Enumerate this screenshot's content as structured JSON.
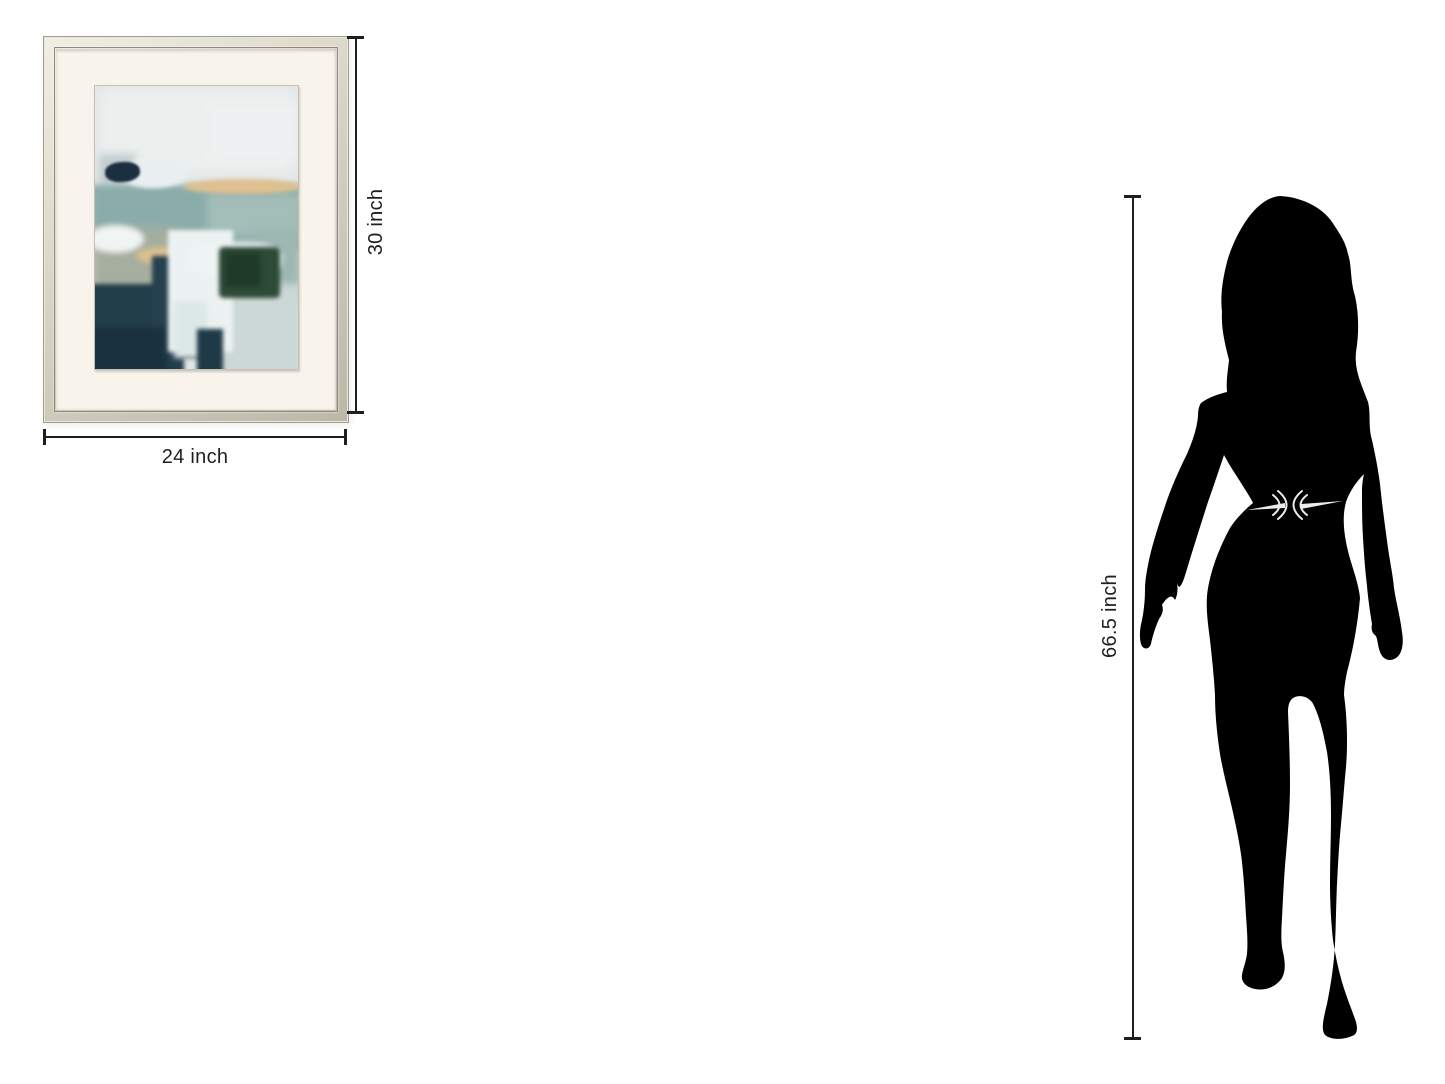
{
  "diagram": {
    "artwork": {
      "width_label": "24 inch",
      "height_label": "30 inch",
      "frame_color": "#d8d3c4",
      "mat_color": "#f8f4eb",
      "painting_layers": [
        {
          "name": "sky-haze",
          "l": 2,
          "t": 1,
          "w": 96,
          "h": 30,
          "c": "#ebefee",
          "b": 6
        },
        {
          "name": "sky-patch-right",
          "l": 55,
          "t": 6,
          "w": 44,
          "h": 20,
          "c": "#eef1f1",
          "b": 5
        },
        {
          "name": "gray-smudge-left",
          "l": 2,
          "t": 24,
          "w": 18,
          "h": 12,
          "c": "#c2cdcf",
          "b": 4
        },
        {
          "name": "sea-band",
          "l": -2,
          "t": 35,
          "w": 104,
          "h": 23,
          "c": "#8badaa",
          "b": 3
        },
        {
          "name": "sea-light-right",
          "l": 55,
          "t": 38,
          "w": 47,
          "h": 15,
          "c": "#a3bdb8",
          "b": 4
        },
        {
          "name": "white-stroke-upper",
          "l": 13,
          "t": 25,
          "w": 33,
          "h": 11,
          "c": "#e9eff0",
          "b": 2,
          "rad": "50%",
          "r": -2
        },
        {
          "name": "navy-stroke-upper",
          "l": 5,
          "t": 27,
          "w": 17,
          "h": 7,
          "c": "#1c2f3f",
          "b": 1,
          "rad": "45%",
          "r": -4
        },
        {
          "name": "tan-streak-upper",
          "l": 44,
          "t": 33,
          "w": 58,
          "h": 5,
          "c": "#dfc091",
          "b": 2,
          "rad": "50%"
        },
        {
          "name": "sage-region",
          "l": -2,
          "t": 50,
          "w": 42,
          "h": 30,
          "c": "#a6ae9f",
          "b": 5
        },
        {
          "name": "white-blob-left",
          "l": -4,
          "t": 49,
          "w": 28,
          "h": 10,
          "c": "#f0f4f3",
          "b": 3,
          "rad": "50%"
        },
        {
          "name": "tan-streak-lower",
          "l": 20,
          "t": 57,
          "w": 30,
          "h": 6,
          "c": "#ddc18e",
          "b": 3,
          "rad": "50%"
        },
        {
          "name": "teal-right-mid",
          "l": 80,
          "t": 50,
          "w": 22,
          "h": 28,
          "c": "#9db7b2",
          "b": 5
        },
        {
          "name": "light-bottom-right",
          "l": 52,
          "t": 70,
          "w": 50,
          "h": 32,
          "c": "#ccd8d6",
          "b": 4
        },
        {
          "name": "dark-teal-bottom-left",
          "l": -3,
          "t": 70,
          "w": 47,
          "h": 34,
          "c": "#223e4b",
          "b": 2
        },
        {
          "name": "navy-column-center",
          "l": 28,
          "t": 60,
          "w": 26,
          "h": 36,
          "c": "#26404f",
          "b": 2
        },
        {
          "name": "navy-deep-bottom-left",
          "l": -3,
          "t": 85,
          "w": 38,
          "h": 18,
          "c": "#1a323f",
          "b": 3
        },
        {
          "name": "white-impasto-main",
          "l": 36,
          "t": 51,
          "w": 32,
          "h": 43,
          "c": "#ecf2f2",
          "b": 2
        },
        {
          "name": "white-impasto-flare",
          "l": 46,
          "t": 55,
          "w": 46,
          "h": 12,
          "c": "#eef3f3",
          "b": 3,
          "rad": "40%"
        },
        {
          "name": "green-block",
          "l": 61,
          "t": 57,
          "w": 30,
          "h": 18,
          "c": "#2e4b38",
          "b": 2,
          "rad": "8%"
        },
        {
          "name": "green-core",
          "l": 64,
          "t": 59,
          "w": 18,
          "h": 12,
          "c": "#1f3a29",
          "b": 3
        },
        {
          "name": "white-streak-down",
          "l": 39,
          "t": 76,
          "w": 16,
          "h": 20,
          "c": "#dce7e7",
          "b": 3
        },
        {
          "name": "navy-bottom-center",
          "l": 50,
          "t": 86,
          "w": 13,
          "h": 16,
          "c": "#1e3a47",
          "b": 2
        }
      ]
    },
    "person": {
      "height_label": "66.5 inch",
      "silhouette_color": "#000000",
      "belt_color": "#ececec"
    },
    "annotation": {
      "line_color": "#1e1e1e",
      "text_color": "#1f1f1f"
    }
  }
}
